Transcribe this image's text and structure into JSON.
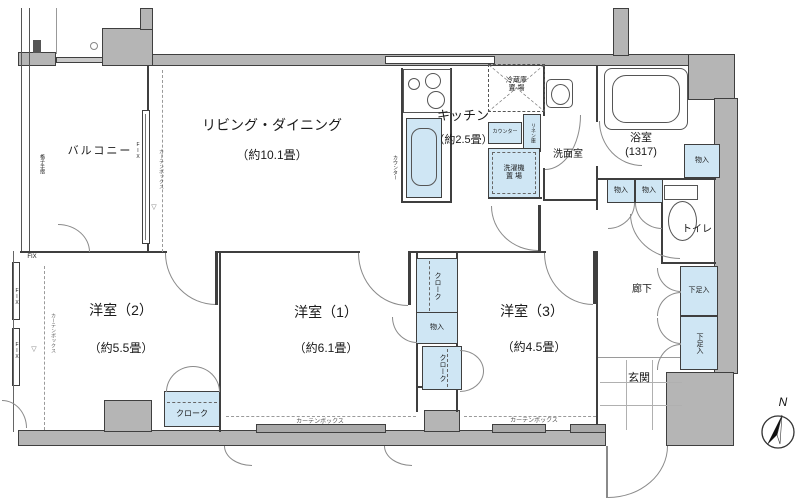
{
  "colors": {
    "wall_fill": "#b5b5b5",
    "storage_fill": "#cfe6f4",
    "outline": "#3f3f3f"
  },
  "rooms": {
    "balcony": {
      "label": "バルコニー"
    },
    "living": {
      "label": "リビング・ダイニング",
      "size": "（約10.1畳）"
    },
    "kitchen": {
      "label": "キッチン",
      "size": "（約2.5畳）"
    },
    "washroom": {
      "label": "洗面室"
    },
    "bathroom": {
      "label": "浴室",
      "size": "(1317)"
    },
    "toilet": {
      "label": "トイレ"
    },
    "hallway": {
      "label": "廊下"
    },
    "entrance": {
      "label": "玄関"
    },
    "bedroom2": {
      "label": "洋室（2）",
      "size": "（約5.5畳）"
    },
    "bedroom1": {
      "label": "洋室（1）",
      "size": "（約6.1畳）"
    },
    "bedroom3": {
      "label": "洋室（3）",
      "size": "（約4.5畳）"
    }
  },
  "storage": {
    "closet": "物入",
    "shoe_cabinet": "下足入",
    "cloak": "クローク",
    "linen": "リネン庫",
    "counter": "カウンター",
    "refrigerator_line1": "冷蔵庫",
    "refrigerator_line2": "置 場",
    "washer_line1": "洗濯機",
    "washer_line2": "置 場"
  },
  "annotations": {
    "curtain_box": "カーテンボックス",
    "fix": "FIX",
    "handrail": "格子手摺",
    "north": "N"
  }
}
